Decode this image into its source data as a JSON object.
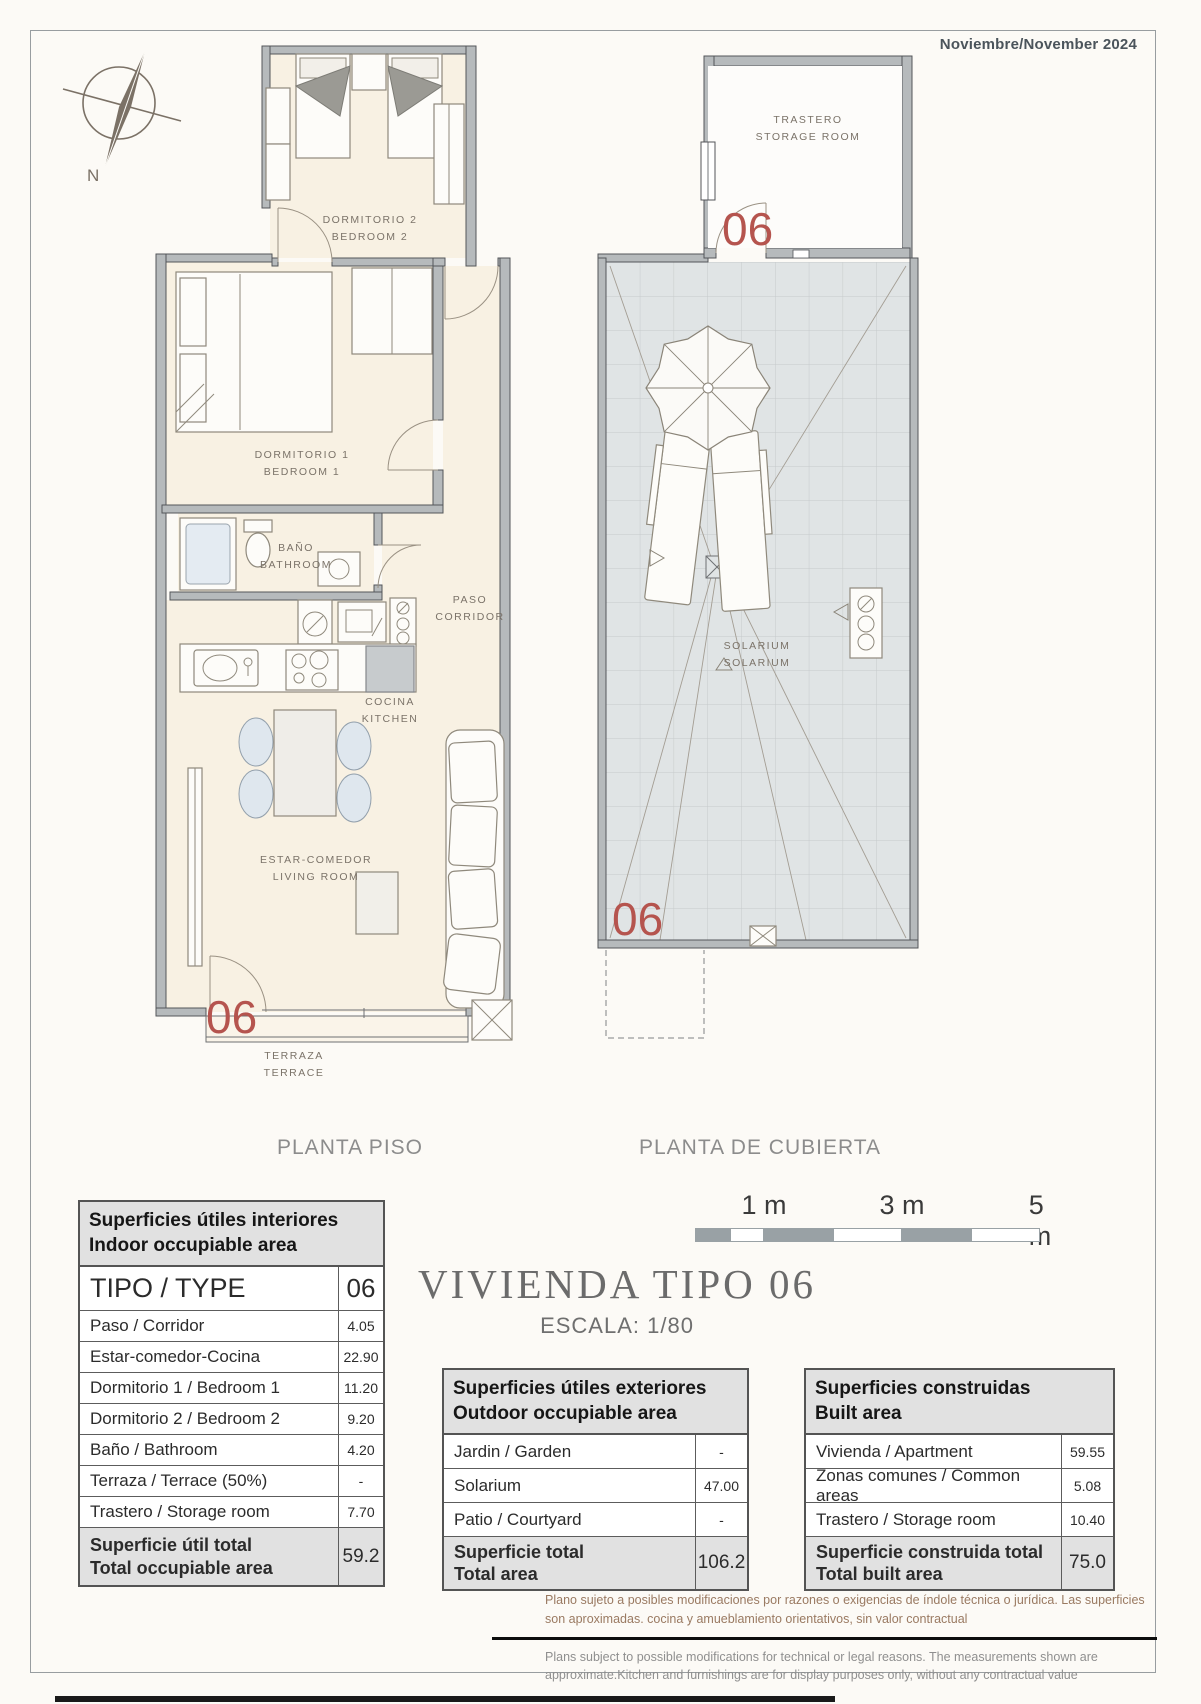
{
  "meta": {
    "date": "Noviembre/November 2024"
  },
  "compass": {
    "north": "N"
  },
  "unit_number": "06",
  "plan_titles": {
    "floor": "PLANTA PISO",
    "roof": "PLANTA DE CUBIERTA"
  },
  "rooms": {
    "bedroom2": {
      "es": "DORMITORIO 2",
      "en": "BEDROOM 2"
    },
    "bedroom1": {
      "es": "DORMITORIO 1",
      "en": "BEDROOM 1"
    },
    "bathroom": {
      "es": "BAÑO",
      "en": "BATHROOM"
    },
    "corridor": {
      "es": "PASO",
      "en": "CORRIDOR"
    },
    "kitchen": {
      "es": "COCINA",
      "en": "KITCHEN"
    },
    "living": {
      "es": "ESTAR-COMEDOR",
      "en": "LIVING ROOM"
    },
    "terrace": {
      "es": "TERRAZA",
      "en": "TERRACE"
    },
    "storage": {
      "es": "TRASTERO",
      "en": "STORAGE ROOM"
    },
    "solarium": {
      "es": "SOLARIUM",
      "en": "SOLARIUM"
    }
  },
  "title": {
    "main": "VIVIENDA TIPO 06",
    "scale": "ESCALA: 1/80"
  },
  "scalebar": {
    "labels": [
      "1 m",
      "3 m",
      "5 m"
    ]
  },
  "tables": {
    "interior": {
      "title_es": "Superficies útiles interiores",
      "title_en": "Indoor occupiable area",
      "type_label": "TIPO / TYPE",
      "type_value": "06",
      "rows": [
        {
          "label": "Paso / Corridor",
          "value": "4.05"
        },
        {
          "label": "Estar-comedor-Cocina",
          "value": "22.90"
        },
        {
          "label": "Dormitorio 1 / Bedroom 1",
          "value": "11.20"
        },
        {
          "label": "Dormitorio 2 / Bedroom 2",
          "value": "9.20"
        },
        {
          "label": "Baño / Bathroom",
          "value": "4.20"
        },
        {
          "label": "Terraza / Terrace (50%)",
          "value": "-"
        },
        {
          "label": "Trastero / Storage room",
          "value": "7.70"
        }
      ],
      "total": {
        "label_es": "Superficie útil total",
        "label_en": "Total occupiable area",
        "value": "59.2"
      }
    },
    "exterior": {
      "title_es": "Superficies útiles exteriores",
      "title_en": "Outdoor occupiable area",
      "rows": [
        {
          "label": "Jardin / Garden",
          "value": "-"
        },
        {
          "label": "Solarium",
          "value": "47.00"
        },
        {
          "label": "Patio / Courtyard",
          "value": "-"
        }
      ],
      "total": {
        "label_es": "Superficie total",
        "label_en": "Total area",
        "value": "106.2"
      }
    },
    "built": {
      "title_es": "Superficies construidas",
      "title_en": "Built area",
      "rows": [
        {
          "label": "Vivienda / Apartment",
          "value": "59.55"
        },
        {
          "label": "Zonas comunes / Common areas",
          "value": "5.08"
        },
        {
          "label": "Trastero / Storage room",
          "value": "10.40"
        }
      ],
      "total": {
        "label_es": "Superficie construida total",
        "label_en": "Total built area",
        "value": "75.0"
      }
    }
  },
  "disclaimer": {
    "es": "Plano sujeto a posibles modificaciones por razones o exigencias de índole técnica o jurídica. Las superficies son aproximadas. cocina y amueblamiento  orientativos, sin valor contractual",
    "en": "Plans subject to possible modifications for technical or legal reasons. The measurements shown are approximate.Kitchen and furnishings are for display purposes only, without any contractual value"
  },
  "colors": {
    "unit_red": "#b5544e",
    "wall": "#b6babc",
    "floor": "#f8f1e3",
    "solarium_tile": "#e0e4e5"
  }
}
